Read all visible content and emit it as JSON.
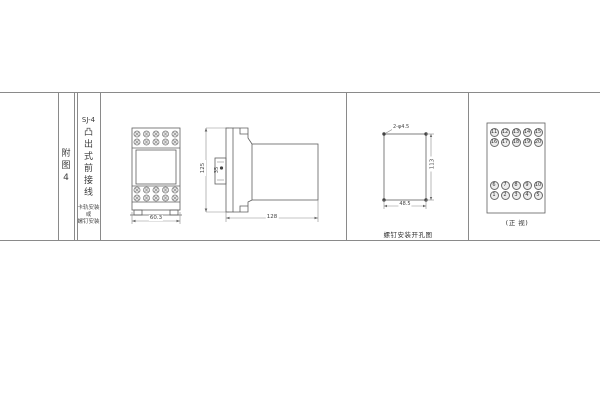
{
  "colors": {
    "line": "#5f5f5f",
    "rule": "#8a8a8a",
    "text": "#3c3c3c"
  },
  "title_block": {
    "figure_label": "附图4",
    "model": "SJ-4",
    "model_desc": "凸出式前接线",
    "mount_note_line1": "卡轨安装",
    "mount_note_line2": "或",
    "mount_note_line3": "螺钉安装"
  },
  "front_view": {
    "width_dim": "60.3"
  },
  "side_view": {
    "height_dim": "125",
    "boss_dim": "35",
    "depth_dim": "128"
  },
  "drill_view": {
    "holes_label": "2-φ4.5",
    "height_dim": "113",
    "width_dim": "48.5",
    "caption": "螺钉安装开孔图"
  },
  "terminal_view": {
    "caption": "(正 视)",
    "top_rows": [
      [
        "11",
        "12",
        "13",
        "14",
        "15"
      ],
      [
        "16",
        "17",
        "18",
        "19",
        "20"
      ]
    ],
    "bottom_rows": [
      [
        "6",
        "7",
        "8",
        "9",
        "10"
      ],
      [
        "1",
        "2",
        "3",
        "4",
        "5"
      ]
    ]
  }
}
